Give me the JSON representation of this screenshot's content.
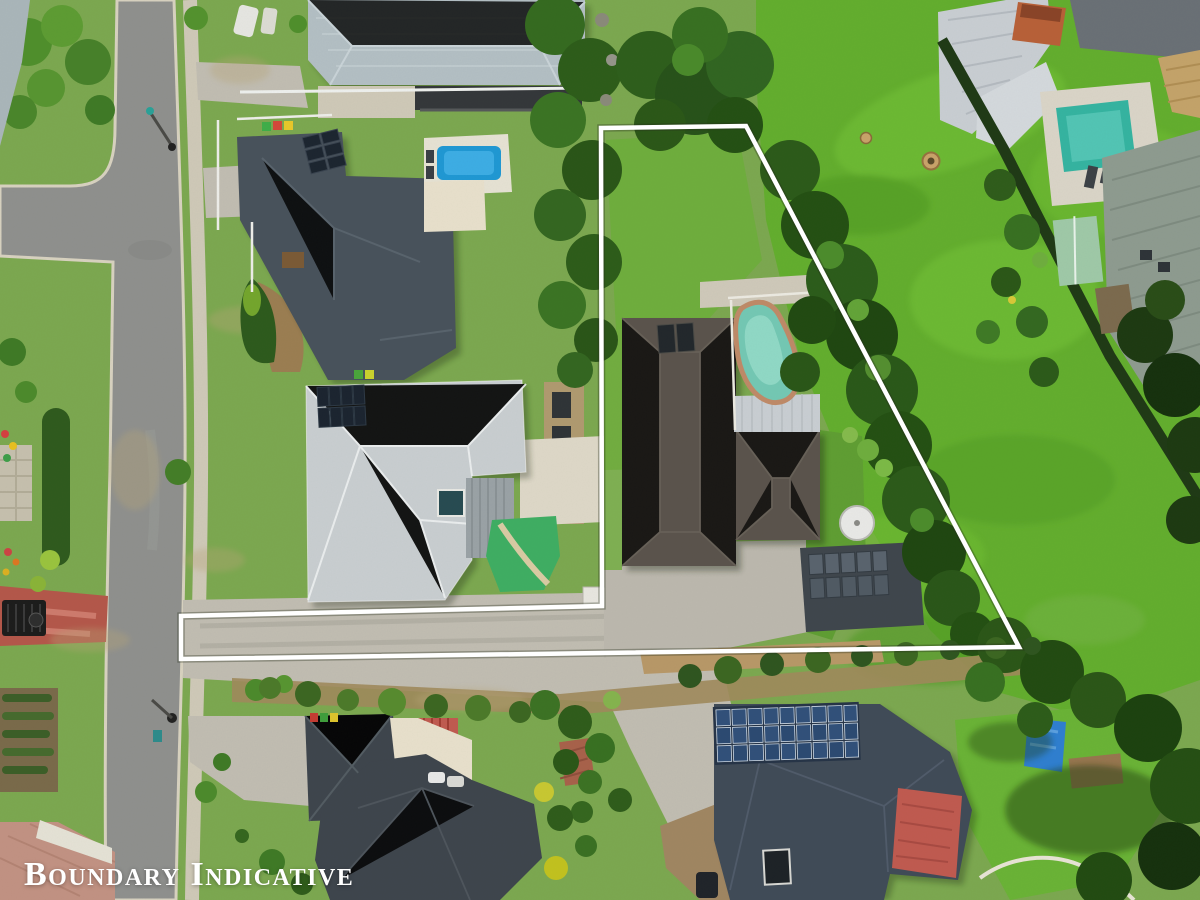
{
  "overlay": {
    "watermark": "Boundary Indicative",
    "watermark_color": "#ffffff",
    "boundary": {
      "color": "#ffffff",
      "stroke_width": 4.5,
      "shadow_color": "rgba(40,50,30,0.35)",
      "points": "601,128 746,126 1019,647 181,659 181,616 602,606"
    }
  },
  "palette": {
    "lawn": "#7ca850",
    "field": "#63ae2e",
    "yard": "#6fae3c",
    "road": "#8f908e",
    "curb": "#d8d2c0",
    "path": "#cfc9b8",
    "concrete": "#bcb8ae",
    "drive": "#c1bdb2",
    "cream": "#e8e0cc",
    "roof_top_neighbor": "#b3bfc4",
    "roof_slate_neighbor": "#48525c",
    "roof_light_neighbor": "#c9ced1",
    "roof_subject": "#5a534c",
    "roof_bottom_left": "#3e454d",
    "roof_bottom_right": "#404b58",
    "shed_dark": "#3f464d",
    "silver_roof": "#c9ced3",
    "pool_blue": "#1f98d4",
    "pool_teal": "#74c8b4",
    "pool_aqua": "#35b4a1",
    "coping": "#bf8a68",
    "mulch": "#a0895c",
    "red_roof": "#c05a50",
    "red_drive": "#b4574a",
    "tree_dark": "#2c5a1a",
    "tree_mid": "#387022",
    "tree_light": "#4c8c2c"
  },
  "scene": {
    "kind": "aerial-drone-photo",
    "objects": [
      "main-road",
      "side-street",
      "footpath",
      "grass-field",
      "field-ring-small",
      "field-ring-large",
      "shared-driveway-strip",
      "subject-house",
      "subject-pool",
      "subject-patio-roof",
      "subject-shed",
      "water-tank",
      "top-neighbor-house",
      "top-neighbor-deck",
      "slate-neighbor-house",
      "blue-pool",
      "light-neighbor-house",
      "putting-green",
      "bottom-left-house",
      "bottom-right-house",
      "solar-array",
      "red-roof-section",
      "blue-tarp",
      "metal-shed-top-right",
      "aqua-pool-top-right",
      "red-crossing",
      "garden-trailer",
      "brick-driveway",
      "veg-garden",
      "boundary-line",
      "boundary-watermark"
    ]
  }
}
